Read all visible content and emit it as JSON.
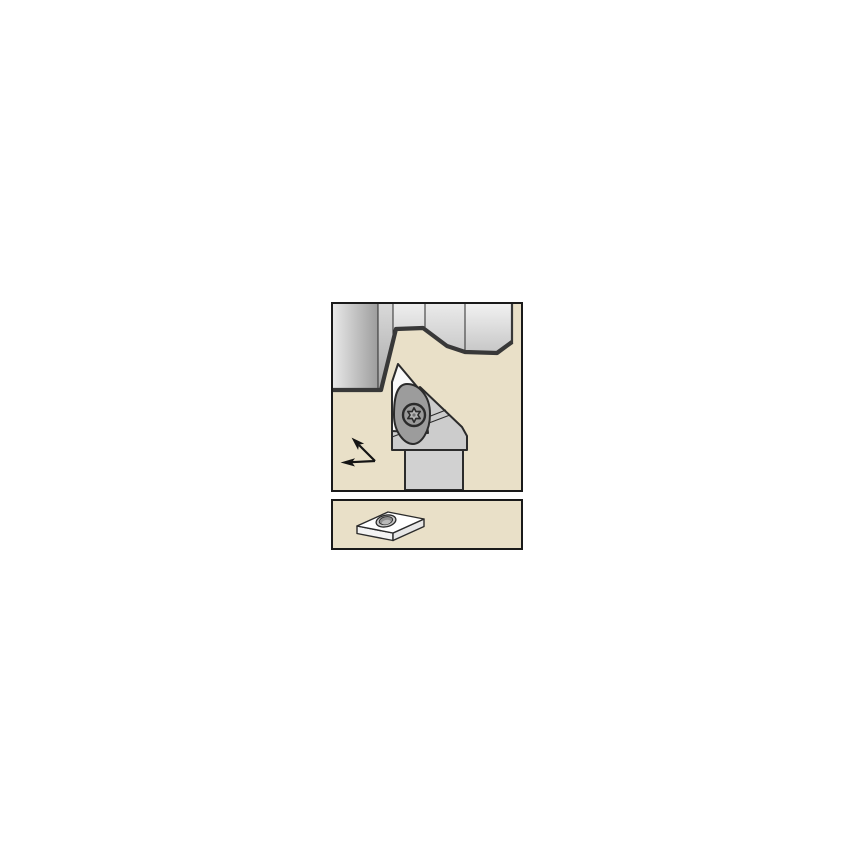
{
  "page": {
    "label": "cutting-tool-catalog-illustration"
  },
  "panels": {
    "application": {
      "label": "toolholder-application-view",
      "parts": {
        "workpiece": "machined-workpiece",
        "toolholder": "turning-toolholder",
        "insert": "indexable-insert",
        "clamp": "d-style-clamp",
        "screw": "torx-clamp-screw",
        "arrows": "feed-direction-arrows"
      }
    },
    "insert_view": {
      "label": "insert-isometric-view",
      "parts": {
        "insert": "diamond-shaped-insert",
        "hole": "insert-center-hole"
      }
    }
  },
  "colors": {
    "canvas": "#ffffff",
    "panel-bg": "#e9e0c8",
    "panel-border": "#1a1a1a",
    "outline": "#2b2b2b",
    "profile": "#383838",
    "wp1a": "#e8e8e8",
    "wp1b": "#9d9d9d",
    "wp2a": "#d9d9d9",
    "wp2b": "#a8a8a8",
    "wp3a": "#eeeeee",
    "wp3b": "#d2d2d2",
    "wp4a": "#eaeaea",
    "wp4b": "#c9c9c9",
    "wp5a": "#f1f1f1",
    "wp5b": "#c6c6c6",
    "holder": "#cccccc",
    "shank": "#d1d1d1",
    "clamp": "#9c9c9c",
    "screw-ring": "#9a9a9a",
    "screw-star": "#b4b4b4",
    "screw-dot": "#6f6f6f",
    "insert-face": "#fafafa",
    "iso-top": "#ffffff",
    "iso-left": "#f3f3f3",
    "iso-right": "#e7e7e7",
    "hole-ring": "#cacaca",
    "hole-bore": "#8f8f8f",
    "hole-glint": "#bababa",
    "arrow": "#141414"
  }
}
